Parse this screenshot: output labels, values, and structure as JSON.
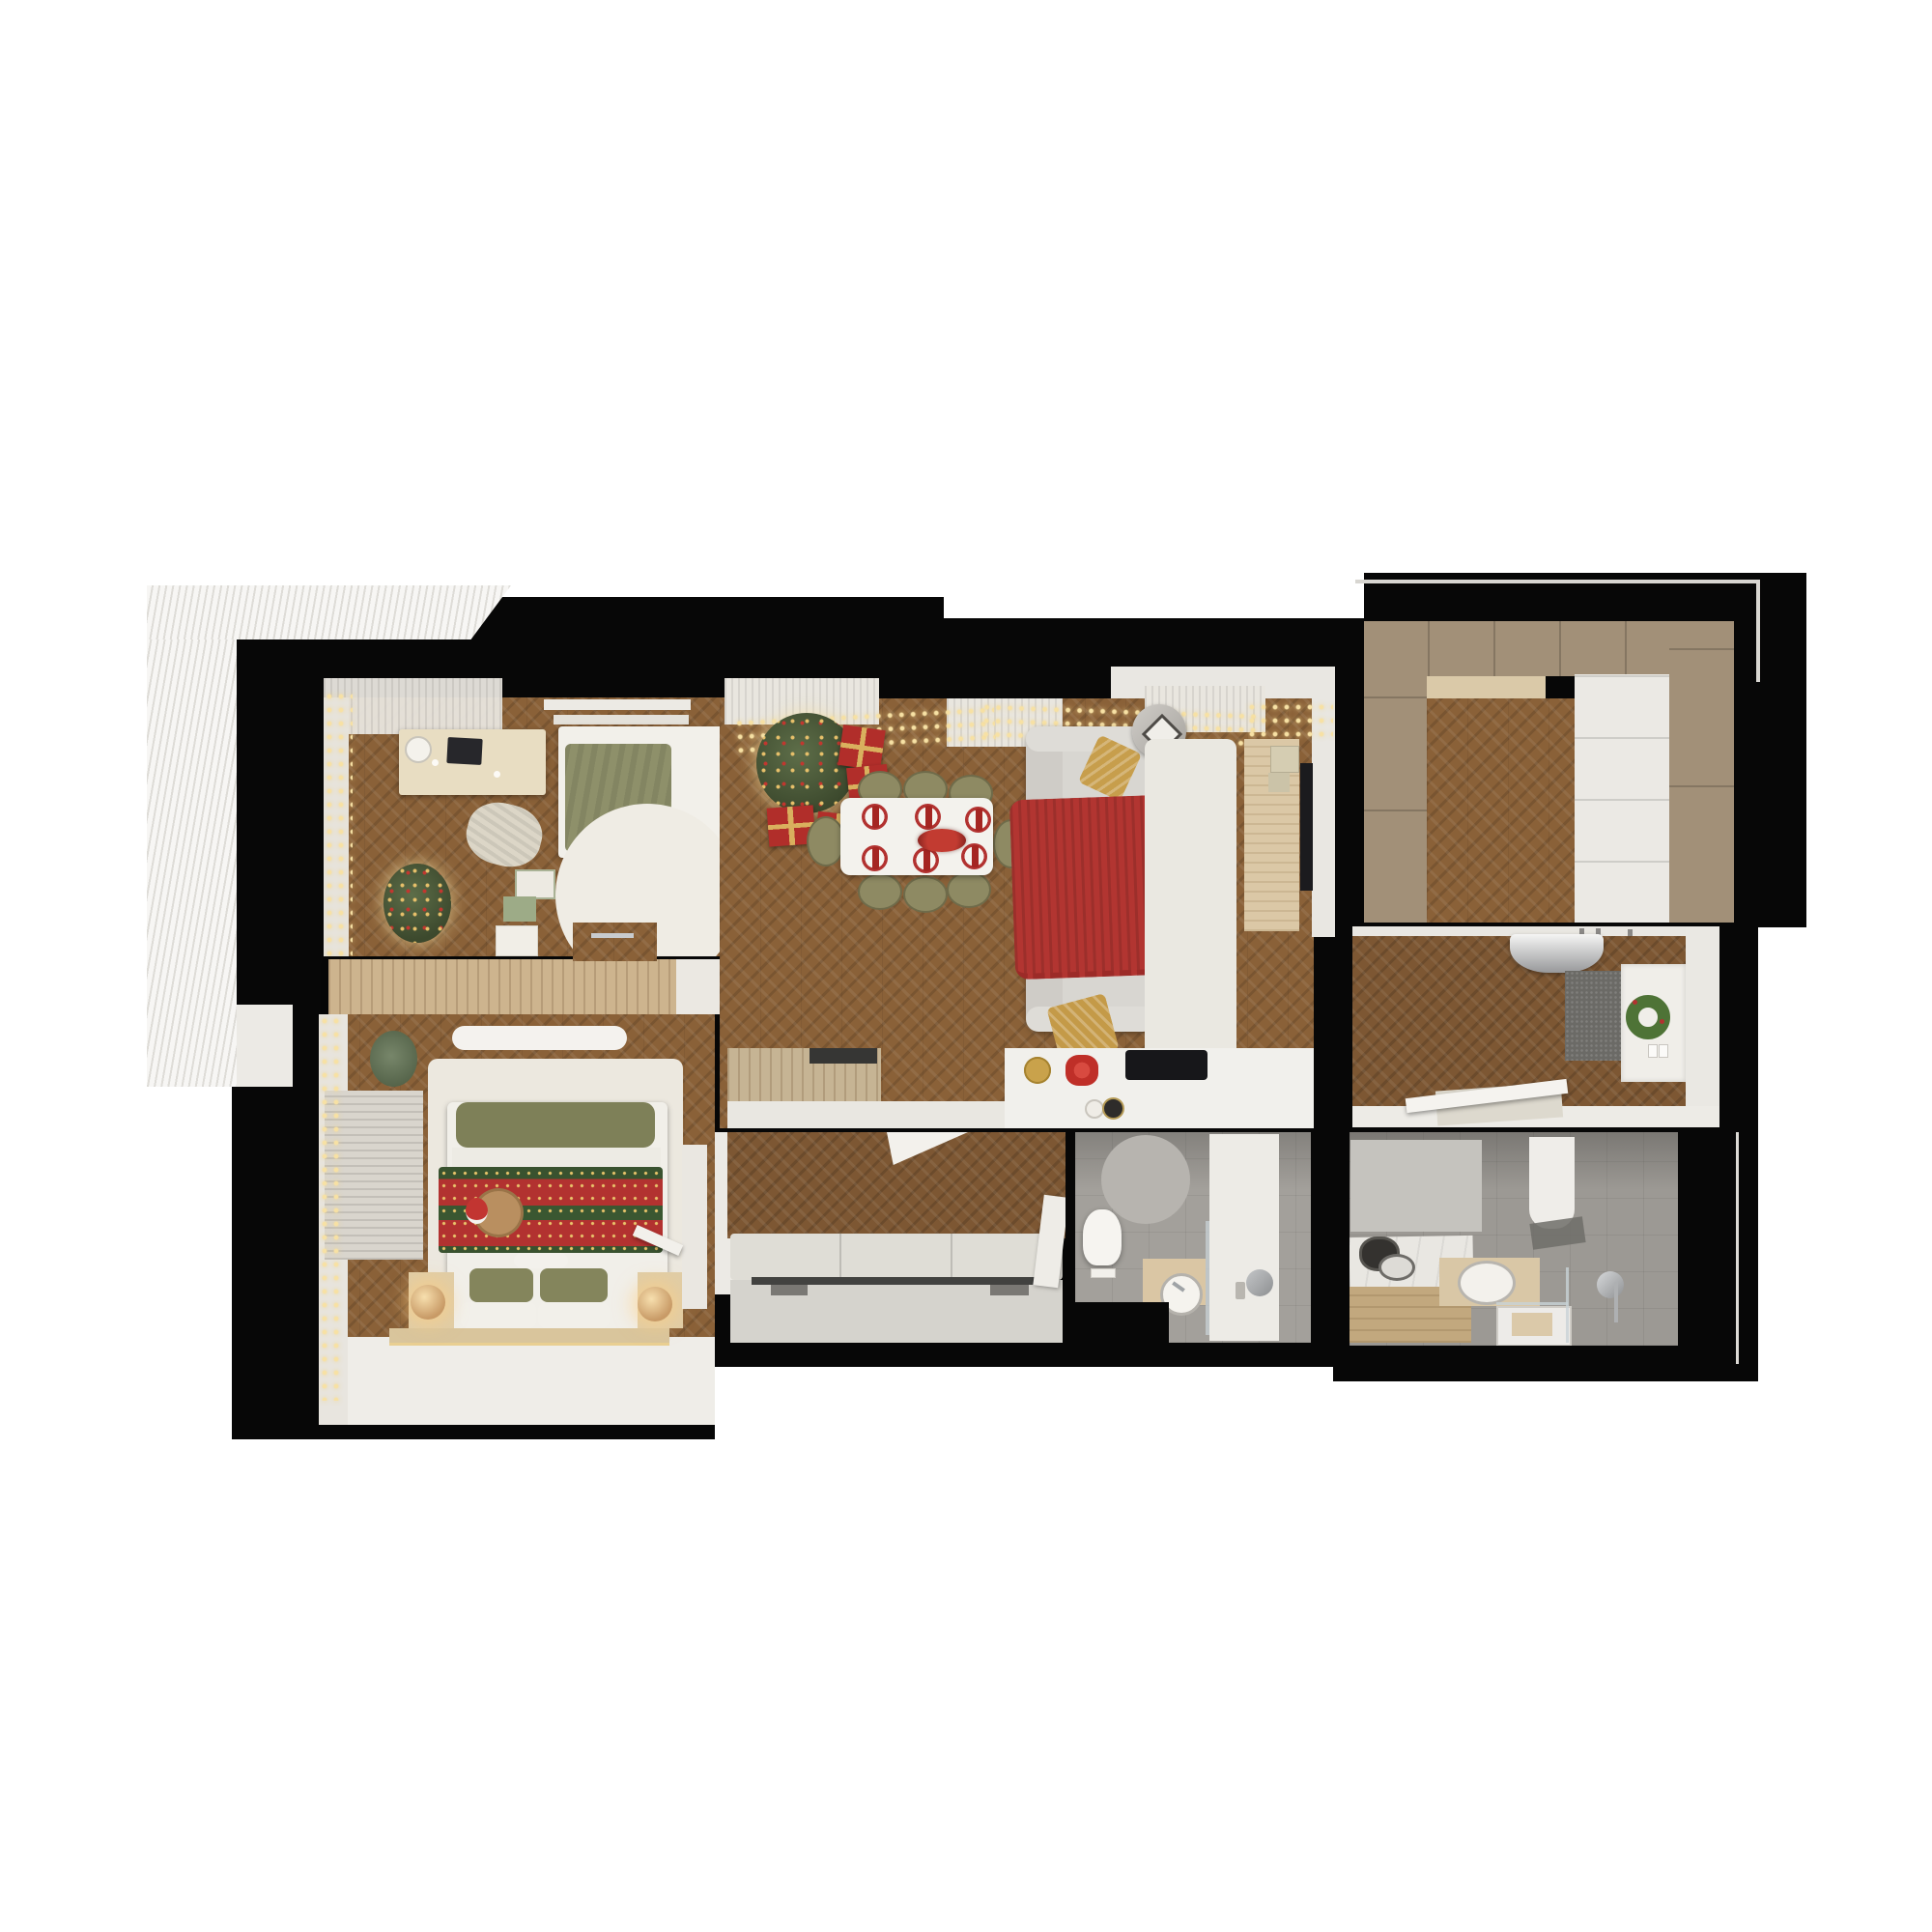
{
  "scene": {
    "description": "Top-down 3D rendered floor plan of an apartment decorated for Christmas",
    "view": "top-down render",
    "background_color": "#ffffff",
    "wall_color": "#070707"
  },
  "palette": {
    "wood_floor": "#8a6138",
    "wood_floor_dark": "#7d5733",
    "light_wood_furniture": "#cdb48e",
    "white_surface": "#efede8",
    "gray_tile": "#a3a09b",
    "taupe_cabinet": "#a29078",
    "sofa_gray": "#d8d6d1",
    "christmas_red": "#b23230",
    "tree_green": "#45532f",
    "gold": "#d9b05e",
    "olive_green": "#8e8a63",
    "string_light_gold": "#f7e1a4"
  },
  "rooms": {
    "balcony": {
      "label": "Balcony with louvered canopy",
      "items": [
        "louvered canopy",
        "tile ledge"
      ]
    },
    "bedroom_office": {
      "label": "Bedroom with home office",
      "items": [
        "desk with laptop",
        "desk lamp",
        "wall shelves",
        "single bed with green duvet",
        "round cream rug",
        "chunky knit blanket",
        "small Christmas tree with white ornaments",
        "gift boxes",
        "string lights",
        "slatted sideboard",
        "sheer curtains"
      ]
    },
    "bedroom_master": {
      "label": "Master bedroom",
      "items": [
        "double bed with festive red-green runner",
        "santa hat on basket",
        "olive green pillows",
        "white pillows",
        "nightstands with glass globe lamps",
        "wood platform",
        "cream rug",
        "slatted dresser",
        "white bench",
        "eucalyptus plant",
        "window blinds with string lights",
        "white wardrobe",
        "open door leaf"
      ]
    },
    "living_dining": {
      "label": "Living room with dining area and open kitchen",
      "items": [
        "decorated Christmas tree with red and gold ornaments",
        "red gift boxes",
        "string light garlands",
        "white dining table for six",
        "olive dining chairs",
        "red festive place settings",
        "red floral centerpiece",
        "gray sofa",
        "gold pillows",
        "red knit throw",
        "round side table with lantern",
        "white rug",
        "TV console",
        "wall TV",
        "wood island cabinet",
        "white kitchen counter",
        "black cooktop",
        "gold ornament bowl",
        "red bow",
        "storage jars",
        "tall white cabinet",
        "curtains"
      ]
    },
    "hallway": {
      "label": "Inner hallway",
      "items": [
        "herringbone floor",
        "bench cushions",
        "white sliding wardrobe",
        "door leaves"
      ]
    },
    "wc": {
      "label": "Shower room",
      "items": [
        "toilet",
        "flush plate",
        "round gray rug",
        "wood vanity with round basin",
        "glass partition",
        "shower area",
        "shower head",
        "toiletry bottles"
      ]
    },
    "bathroom": {
      "label": "Bathroom",
      "items": [
        "wood panel bathtub deck",
        "dark basin",
        "white basin",
        "oval sink on wood counter",
        "square shower tray",
        "glass screen",
        "chrome fixtures",
        "white door",
        "gray wall panel"
      ]
    },
    "entry": {
      "label": "Entrance hall",
      "items": [
        "chrome console",
        "dark gray doormat",
        "green Christmas wreath",
        "light switches",
        "coat hooks",
        "open front door leaf",
        "beige mat"
      ]
    },
    "closet": {
      "label": "Walk-in closet",
      "items": [
        "taupe wardrobe cabinets",
        "white drawer unit",
        "beige counter",
        "herringbone floor"
      ]
    }
  }
}
